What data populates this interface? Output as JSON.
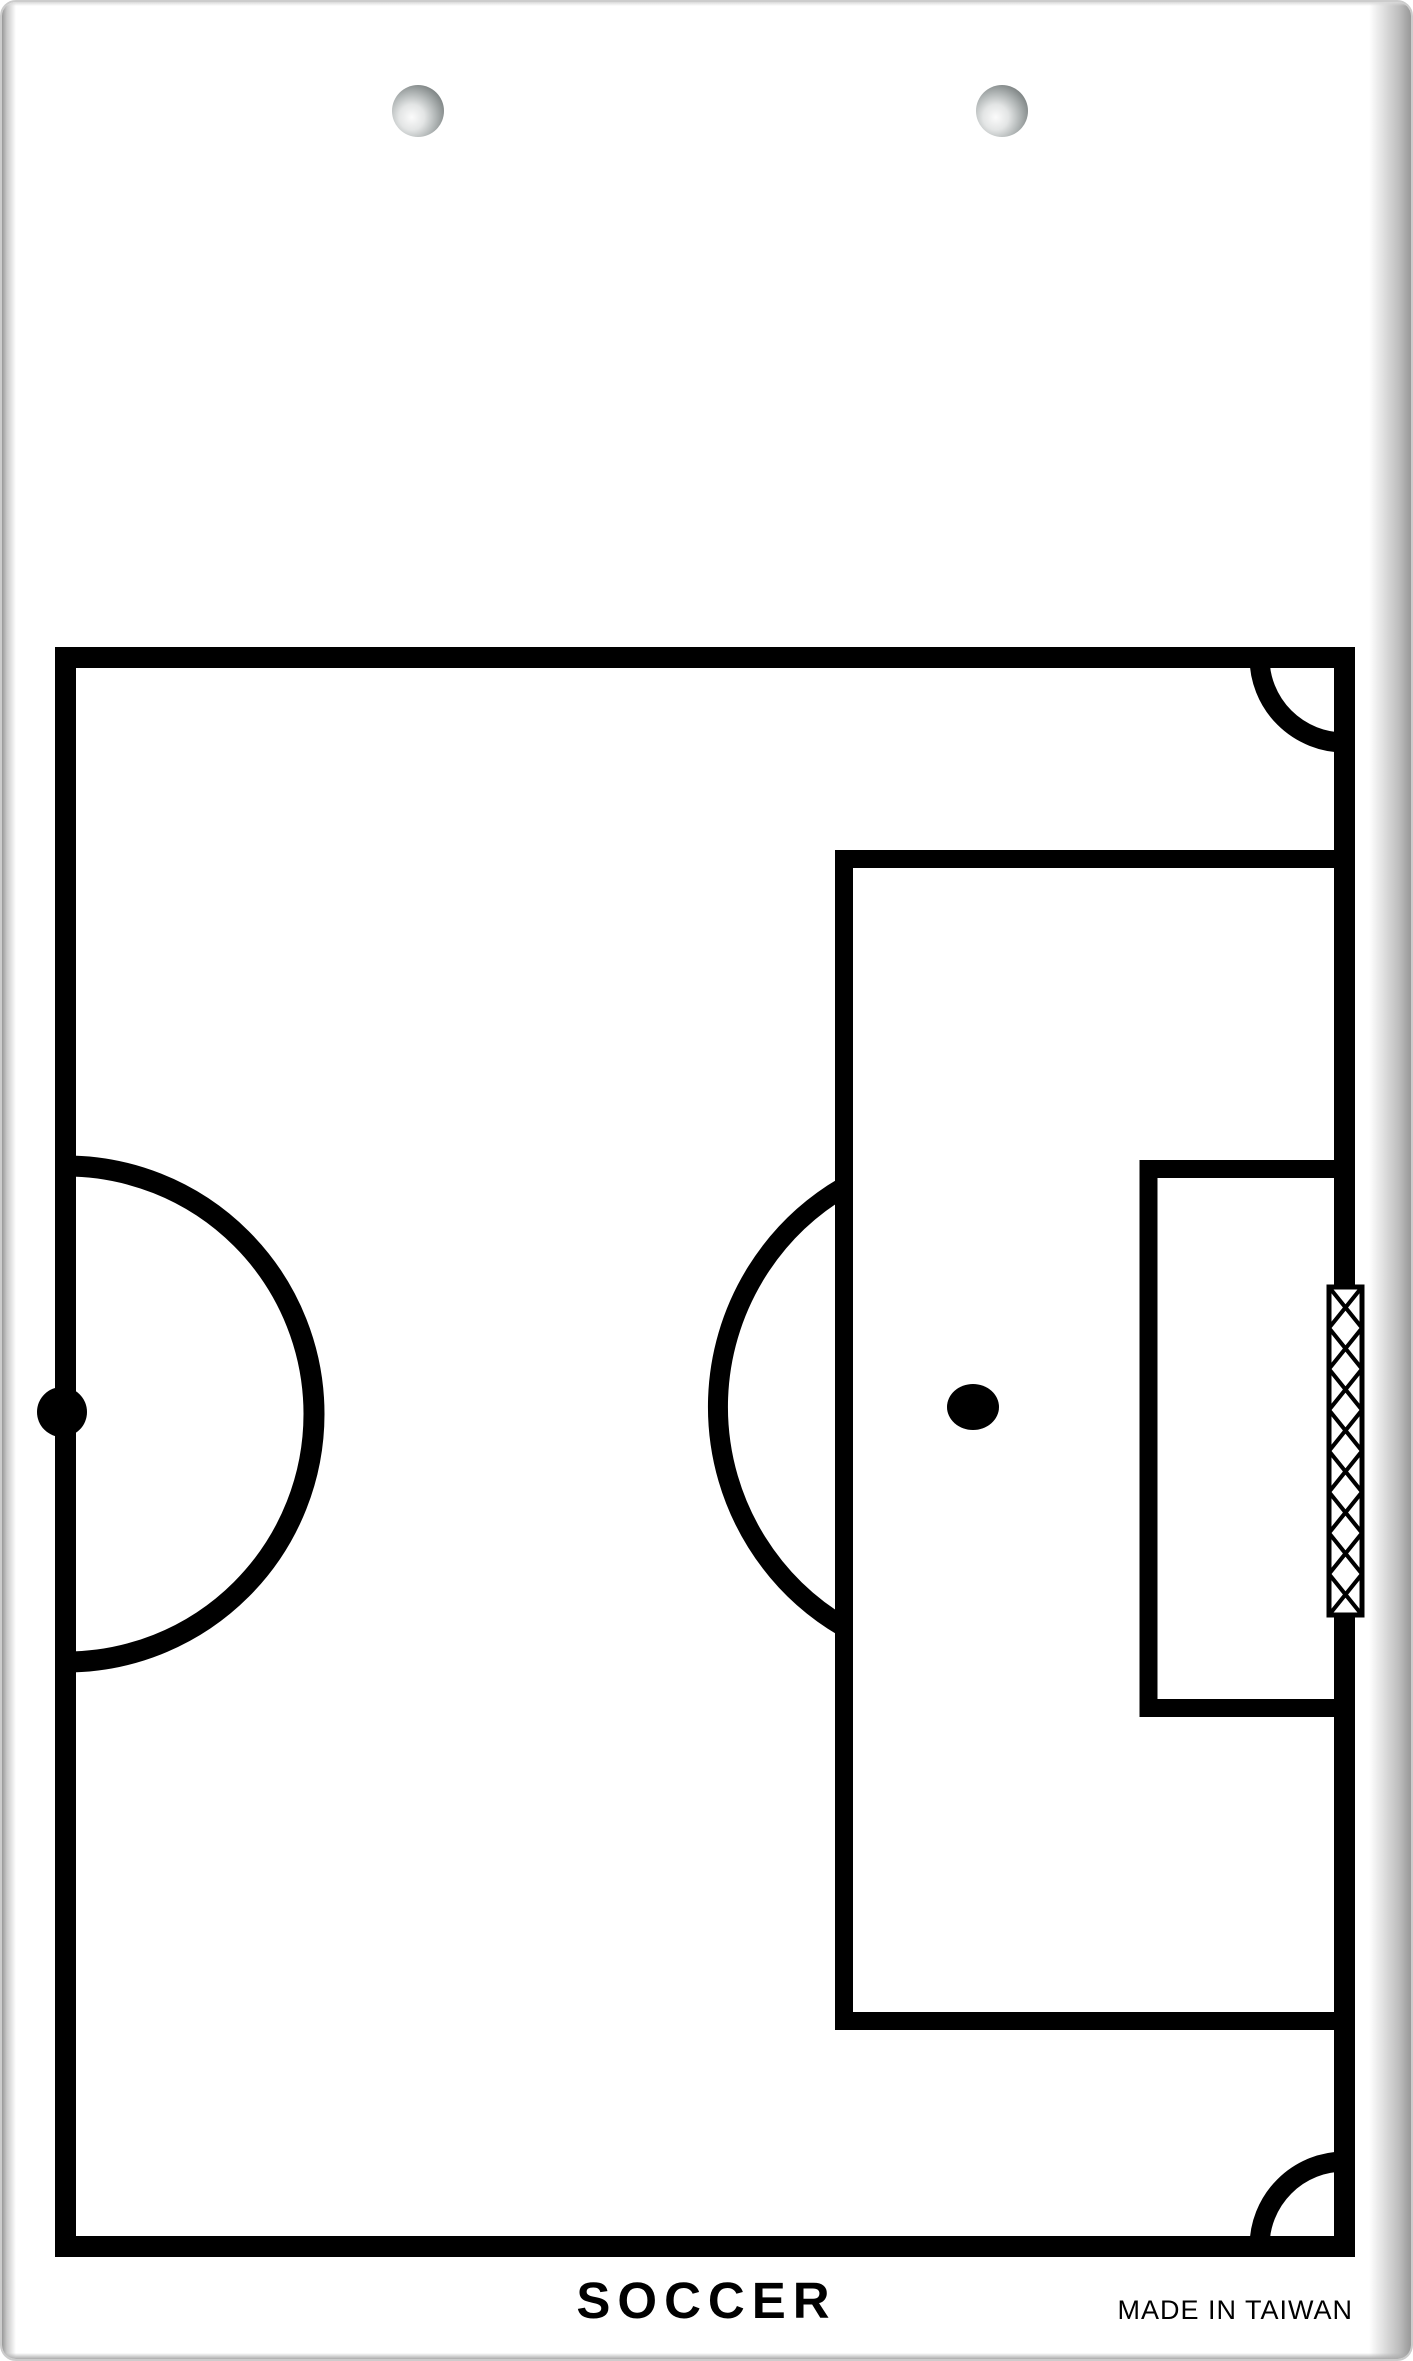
{
  "board": {
    "title": "SOCCER",
    "made_in_label": "MADE IN TAIWAN",
    "background_color": "#ffffff",
    "line_color": "#000000",
    "edge_shadow_color": "#989898",
    "hole_highlight_color": "#fbfbfb",
    "hole_shadow_color": "#4c5252",
    "hole_count": 2
  },
  "diagram": {
    "sport": "soccer",
    "view": "half-field-with-goal",
    "elements": [
      "field-border",
      "corner-arc-top-right",
      "corner-arc-bottom-right",
      "halfway-center-circle-half",
      "center-spot",
      "penalty-area",
      "goal-area",
      "penalty-spot",
      "penalty-arc",
      "goal-net-hatch"
    ]
  }
}
